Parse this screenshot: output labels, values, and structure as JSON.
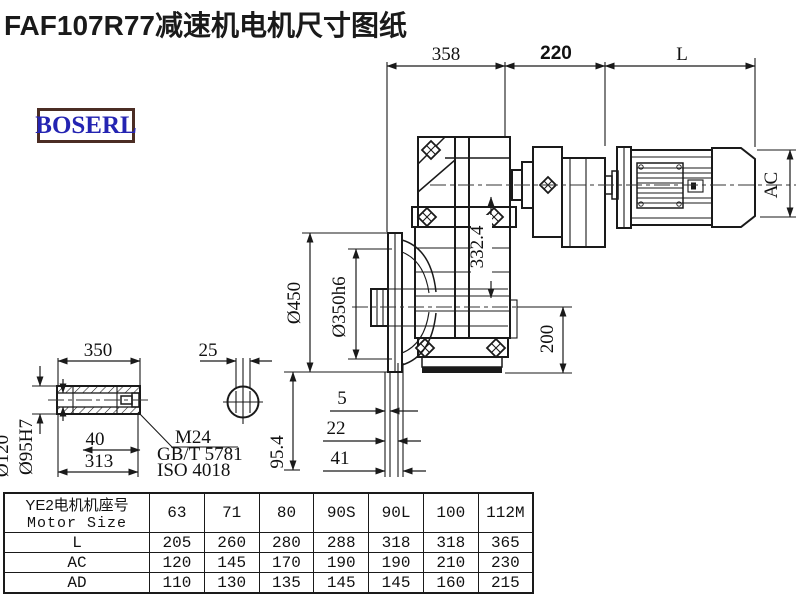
{
  "page": {
    "title": "FAF107R77减速机电机尺寸图纸",
    "logo_text": "BOSERL"
  },
  "drawing": {
    "dims": {
      "top_358": "358",
      "top_220": "220",
      "top_L": "L",
      "ac": "AC",
      "dia450": "Ø450",
      "dia350": "Ø350h6",
      "height_332_4": "332.4",
      "height_200": "200",
      "axial_5": "5",
      "axial_22": "22",
      "axial_41": "41",
      "shaft_len_350": "350",
      "key_25": "25",
      "depth_40": "40",
      "len_313": "313",
      "offset_95_4": "95.4",
      "dia120": "Ø120",
      "dia95": "Ø95H7",
      "thread": "M24",
      "thread_std1": "GB/T 5781",
      "thread_std2": "ISO 4018"
    }
  },
  "table": {
    "header": {
      "row_label_line1": "YE2电机机座号",
      "row_label_line2": "Motor Size",
      "columns": [
        "63",
        "71",
        "80",
        "90S",
        "90L",
        "100",
        "112M"
      ]
    },
    "rows": [
      {
        "label": "L",
        "values": [
          "205",
          "260",
          "280",
          "288",
          "318",
          "318",
          "365"
        ]
      },
      {
        "label": "AC",
        "values": [
          "120",
          "145",
          "170",
          "190",
          "190",
          "210",
          "230"
        ]
      },
      {
        "label": "AD",
        "values": [
          "110",
          "130",
          "135",
          "145",
          "145",
          "160",
          "215"
        ]
      }
    ]
  }
}
